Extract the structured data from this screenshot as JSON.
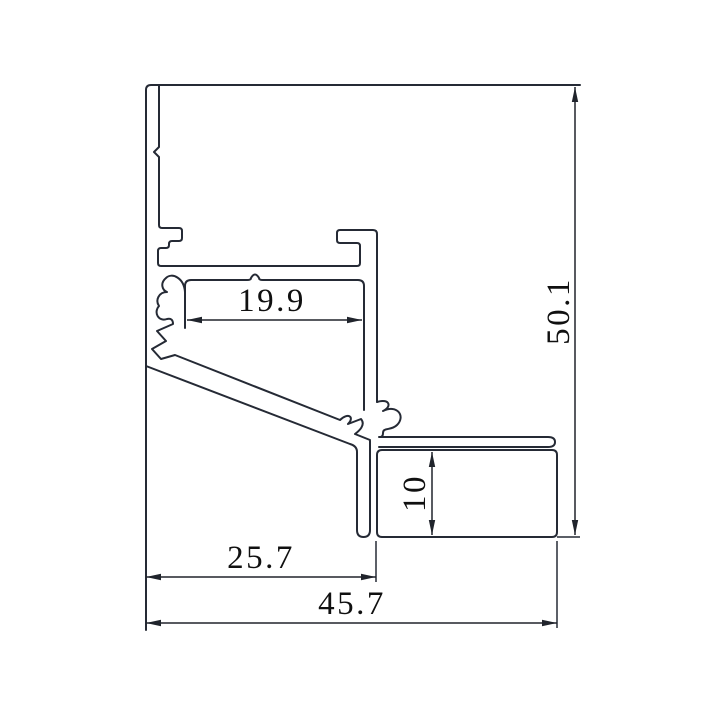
{
  "drawing": {
    "kind": "aluminum-led-profile-cross-section",
    "colors": {
      "background": "#ffffff",
      "profile_line": "#252a35",
      "dimension_line": "#20242c",
      "text": "#101010"
    },
    "dims": {
      "cavity_width": {
        "label": "19.9",
        "value": 19.9
      },
      "overall_height": {
        "label": "50.1",
        "value": 50.1
      },
      "slot_height": {
        "label": "10",
        "value": 10
      },
      "left_section_width": {
        "label": "25.7",
        "value": 25.7
      },
      "overall_width": {
        "label": "45.7",
        "value": 45.7
      }
    }
  }
}
